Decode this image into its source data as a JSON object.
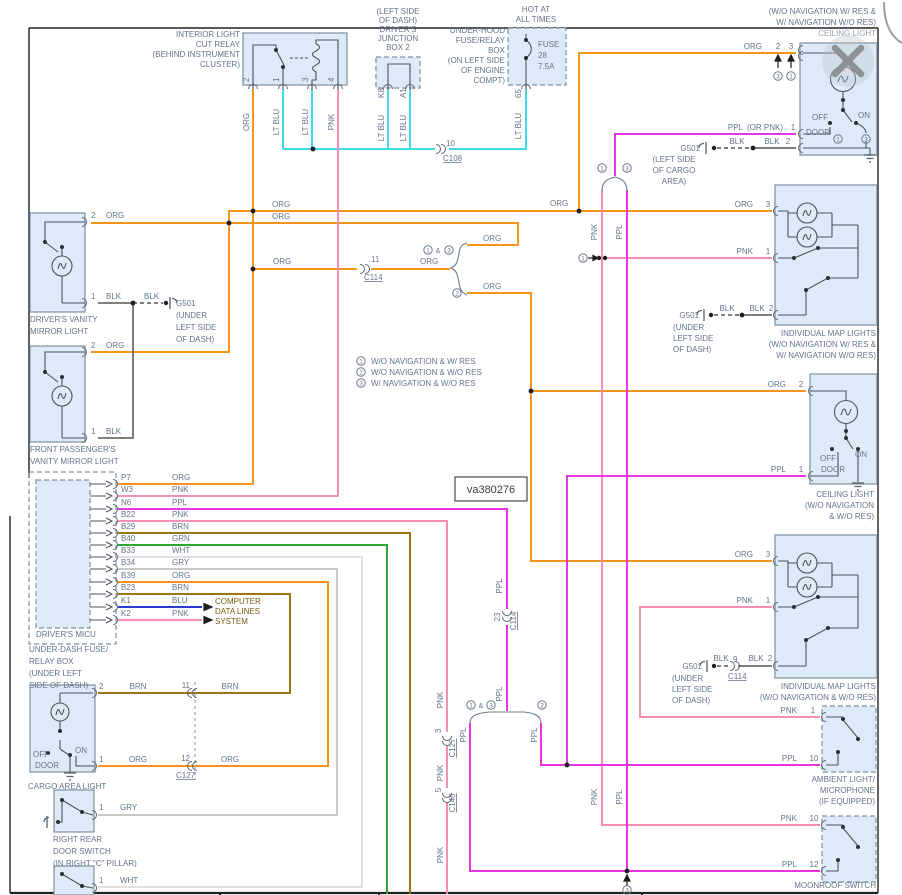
{
  "colors": {
    "org": "#F7941E",
    "ltblu": "#3FD9EE",
    "pnk": "#F78FB5",
    "ppl": "#E835E0",
    "brn": "#9B7613",
    "grn": "#2FA633",
    "wht": "#E0E0E0",
    "gry": "#C8C8C8",
    "blu": "#2B3BD6",
    "blk": "#6E6E6E",
    "box_fill": "#DCEBF7",
    "box_stroke": "#7E8F9F",
    "label": "#64748B",
    "note": "#7A5C10",
    "frame": "#222222"
  },
  "watermark": {
    "text": "va380276"
  },
  "legend": [
    {
      "num": "1",
      "label": "W/O NAVIGATION & W/ RES"
    },
    {
      "num": "2",
      "label": "W/O NAVIGATION & W/O RES"
    },
    {
      "num": "3",
      "label": "W/ NAVIGATION & W/O RES"
    }
  ],
  "labels": [
    {
      "n": "relay-title",
      "x": 240,
      "y": 37,
      "t": "INTERIOR LIGHT",
      "a": "e"
    },
    {
      "x": 240,
      "y": 47,
      "t": "CUT RELAY",
      "a": "e"
    },
    {
      "x": 240,
      "y": 57,
      "t": "(BEHIND INSTRUMENT",
      "a": "e"
    },
    {
      "x": 240,
      "y": 67,
      "t": "CLUSTER)",
      "a": "e"
    },
    {
      "x": 249,
      "y": 82,
      "t": "2",
      "r": 1
    },
    {
      "x": 279,
      "y": 82,
      "t": "1",
      "r": 1
    },
    {
      "x": 308,
      "y": 82,
      "t": "3",
      "r": 1
    },
    {
      "x": 334,
      "y": 82,
      "t": "4",
      "r": 1
    },
    {
      "x": 249,
      "y": 122,
      "t": "ORG",
      "r": 1,
      "a": "m"
    },
    {
      "x": 279,
      "y": 122,
      "t": "LT BLU",
      "r": 1,
      "a": "m"
    },
    {
      "x": 308,
      "y": 122,
      "t": "LT BLU",
      "r": 1,
      "a": "m"
    },
    {
      "x": 334,
      "y": 122,
      "t": "PNK",
      "r": 1,
      "a": "m"
    },
    {
      "n": "junction-box-label",
      "x": 398,
      "y": 14,
      "t": "(LEFT SIDE",
      "a": "m"
    },
    {
      "x": 398,
      "y": 23,
      "t": "OF DASH)",
      "a": "m"
    },
    {
      "x": 398,
      "y": 32,
      "t": "DRIVER'S",
      "a": "m"
    },
    {
      "x": 398,
      "y": 41,
      "t": "JUNCTION",
      "a": "m"
    },
    {
      "x": 398,
      "y": 50,
      "t": "BOX 2",
      "a": "m"
    },
    {
      "x": 384,
      "y": 98,
      "t": "K8",
      "r": 1
    },
    {
      "x": 406,
      "y": 98,
      "t": "A1",
      "r": 1
    },
    {
      "x": 384,
      "y": 128,
      "t": "LT BLU",
      "r": 1,
      "a": "m"
    },
    {
      "x": 406,
      "y": 128,
      "t": "LT BLU",
      "r": 1,
      "a": "m"
    },
    {
      "x": 446,
      "y": 146,
      "t": "10"
    },
    {
      "x": 443,
      "y": 161,
      "t": "C108",
      "u": 1
    },
    {
      "n": "hot-at-all-times",
      "x": 536,
      "y": 12,
      "t": "HOT AT",
      "a": "m"
    },
    {
      "x": 536,
      "y": 22,
      "t": "ALL TIMES",
      "a": "m"
    },
    {
      "n": "underhood-box-label",
      "x": 505,
      "y": 33,
      "t": "UNDER-HOOD",
      "a": "e"
    },
    {
      "x": 505,
      "y": 43,
      "t": "FUSE/RELAY",
      "a": "e"
    },
    {
      "x": 505,
      "y": 53,
      "t": "BOX",
      "a": "e"
    },
    {
      "x": 505,
      "y": 63,
      "t": "(ON LEFT SIDE",
      "a": "e"
    },
    {
      "x": 505,
      "y": 73,
      "t": "OF ENGINE",
      "a": "e"
    },
    {
      "x": 505,
      "y": 83,
      "t": "COMPT)",
      "a": "e"
    },
    {
      "n": "fuse-label",
      "x": 538,
      "y": 47,
      "t": "FUSE"
    },
    {
      "x": 538,
      "y": 58,
      "t": "28"
    },
    {
      "x": 538,
      "y": 69,
      "t": "7.5A"
    },
    {
      "x": 521,
      "y": 98,
      "t": "65",
      "r": 1
    },
    {
      "x": 521,
      "y": 126,
      "t": "LT BLU",
      "r": 1,
      "a": "m"
    },
    {
      "n": "ceiling1-variant",
      "x": 876,
      "y": 14,
      "t": "(W/O NAVIGATION W/ RES &",
      "a": "e"
    },
    {
      "x": 876,
      "y": 25,
      "t": "W/ NAVIGATION W/O RES)",
      "a": "e"
    },
    {
      "n": "ceiling1-title",
      "x": 876,
      "y": 36,
      "t": "CEILING LIGHT",
      "a": "e",
      "c": "#94A1AD"
    },
    {
      "x": 762,
      "y": 49,
      "t": "ORG",
      "a": "e"
    },
    {
      "x": 778,
      "y": 49,
      "t": "2",
      "a": "m"
    },
    {
      "x": 791,
      "y": 49,
      "t": "3",
      "a": "m"
    },
    {
      "x": 778,
      "y": 76,
      "t": "3",
      "circ": 1
    },
    {
      "x": 791,
      "y": 76,
      "t": "1",
      "circ": 1
    },
    {
      "x": 743,
      "y": 130,
      "t": "PPL",
      "a": "e"
    },
    {
      "x": 747,
      "y": 130,
      "t": "(OR PNK)"
    },
    {
      "x": 793,
      "y": 130,
      "t": "1",
      "a": "m"
    },
    {
      "x": 737,
      "y": 144,
      "t": "BLK",
      "a": "m"
    },
    {
      "x": 772,
      "y": 144,
      "t": "BLK",
      "a": "m"
    },
    {
      "x": 788,
      "y": 144,
      "t": "2",
      "a": "m"
    },
    {
      "x": 700,
      "y": 151,
      "t": "G501",
      "a": "e"
    },
    {
      "x": 674,
      "y": 162,
      "t": "(LEFT SIDE",
      "a": "m"
    },
    {
      "x": 674,
      "y": 173,
      "t": "OF CARGO",
      "a": "m"
    },
    {
      "x": 674,
      "y": 184,
      "t": "AREA)",
      "a": "m"
    },
    {
      "x": 820,
      "y": 120,
      "t": "OFF",
      "a": "m"
    },
    {
      "x": 864,
      "y": 118,
      "t": "ON",
      "a": "m"
    },
    {
      "x": 818,
      "y": 135,
      "t": "DOOR",
      "a": "m"
    },
    {
      "x": 838,
      "y": 139,
      "t": "1",
      "circ": 1
    },
    {
      "x": 866,
      "y": 139,
      "t": "3",
      "circ": 1
    },
    {
      "x": 272,
      "y": 207,
      "t": "ORG"
    },
    {
      "x": 272,
      "y": 219,
      "t": "ORG"
    },
    {
      "x": 550,
      "y": 206,
      "t": "ORG"
    },
    {
      "x": 753,
      "y": 207,
      "t": "ORG",
      "a": "e"
    },
    {
      "x": 768,
      "y": 207,
      "t": "3",
      "a": "m"
    },
    {
      "x": 273,
      "y": 264,
      "t": "ORG"
    },
    {
      "x": 420,
      "y": 264,
      "t": "ORG"
    },
    {
      "x": 371,
      "y": 262,
      "t": "11"
    },
    {
      "x": 364,
      "y": 280,
      "t": "C114",
      "u": 1
    },
    {
      "x": 428,
      "y": 250,
      "t": "1",
      "circ": 1
    },
    {
      "x": 438,
      "y": 253,
      "t": "&",
      "a": "m",
      "fs": 7
    },
    {
      "x": 449,
      "y": 250,
      "t": "3",
      "circ": 1
    },
    {
      "x": 483,
      "y": 241,
      "t": "ORG"
    },
    {
      "x": 457,
      "y": 293,
      "t": "2",
      "circ": 1
    },
    {
      "x": 483,
      "y": 289,
      "t": "ORG"
    },
    {
      "x": 602,
      "y": 168,
      "t": "1",
      "circ": 1
    },
    {
      "x": 627,
      "y": 168,
      "t": "3",
      "circ": 1
    },
    {
      "x": 597,
      "y": 232,
      "t": "PNK",
      "r": 1,
      "a": "m"
    },
    {
      "x": 622,
      "y": 232,
      "t": "PPL",
      "r": 1,
      "a": "m"
    },
    {
      "x": 583,
      "y": 258,
      "t": "1",
      "circ": 1
    },
    {
      "x": 753,
      "y": 254,
      "t": "PNK",
      "a": "e"
    },
    {
      "x": 768,
      "y": 254,
      "t": "1",
      "a": "m"
    },
    {
      "x": 699,
      "y": 318,
      "t": "G501",
      "a": "e"
    },
    {
      "x": 727,
      "y": 311,
      "t": "BLK",
      "a": "m"
    },
    {
      "x": 757,
      "y": 311,
      "t": "BLK",
      "a": "m"
    },
    {
      "x": 771,
      "y": 311,
      "t": "2",
      "a": "m"
    },
    {
      "x": 673,
      "y": 330,
      "t": "(UNDER"
    },
    {
      "x": 673,
      "y": 341,
      "t": "LEFT SIDE"
    },
    {
      "x": 673,
      "y": 352,
      "t": "OF DASH)"
    },
    {
      "n": "map1-title",
      "x": 876,
      "y": 336,
      "t": "INDIVIDUAL MAP LIGHTS",
      "a": "e"
    },
    {
      "x": 876,
      "y": 347,
      "t": "(W/O NAVIGATION W/ RES &",
      "a": "e"
    },
    {
      "x": 876,
      "y": 358,
      "t": "W/ NAVIGATION W/O RES)",
      "a": "e"
    },
    {
      "x": 361,
      "y": 361,
      "t": "1",
      "circ": 1
    },
    {
      "n": "legend-1",
      "x": 371,
      "y": 364,
      "t": "W/O NAVIGATION & W/ RES"
    },
    {
      "x": 361,
      "y": 372,
      "t": "2",
      "circ": 1
    },
    {
      "n": "legend-2",
      "x": 371,
      "y": 375,
      "t": "W/O NAVIGATION & W/O RES"
    },
    {
      "x": 361,
      "y": 383,
      "t": "3",
      "circ": 1
    },
    {
      "n": "legend-3",
      "x": 371,
      "y": 386,
      "t": "W/ NAVIGATION & W/O RES"
    },
    {
      "x": 91,
      "y": 218,
      "t": "2"
    },
    {
      "x": 106,
      "y": 218,
      "t": "ORG"
    },
    {
      "x": 91,
      "y": 299,
      "t": "1"
    },
    {
      "x": 106,
      "y": 299,
      "t": "BLK"
    },
    {
      "x": 144,
      "y": 299,
      "t": "BLK"
    },
    {
      "x": 176,
      "y": 306,
      "t": "G501"
    },
    {
      "x": 176,
      "y": 318,
      "t": "(UNDER"
    },
    {
      "x": 176,
      "y": 330,
      "t": "LEFT SIDE"
    },
    {
      "x": 176,
      "y": 342,
      "t": "OF DASH)"
    },
    {
      "n": "vanity1-title",
      "x": 30,
      "y": 322,
      "t": "DRIVER'S VANITY"
    },
    {
      "x": 30,
      "y": 334,
      "t": "MIRROR LIGHT"
    },
    {
      "x": 91,
      "y": 348,
      "t": "2"
    },
    {
      "x": 106,
      "y": 348,
      "t": "ORG"
    },
    {
      "x": 91,
      "y": 434,
      "t": "1"
    },
    {
      "x": 106,
      "y": 434,
      "t": "BLK"
    },
    {
      "n": "vanity2-title",
      "x": 30,
      "y": 452,
      "t": "FRONT PASSENGER'S"
    },
    {
      "x": 30,
      "y": 464,
      "t": "VANITY MIRROR LIGHT"
    },
    {
      "x": 121,
      "y": 480,
      "t": "P7"
    },
    {
      "x": 121,
      "y": 492,
      "t": "W3"
    },
    {
      "x": 121,
      "y": 505,
      "t": "N6"
    },
    {
      "x": 121,
      "y": 517,
      "t": "B22"
    },
    {
      "x": 121,
      "y": 529,
      "t": "B29"
    },
    {
      "x": 121,
      "y": 541,
      "t": "B40"
    },
    {
      "x": 121,
      "y": 553,
      "t": "B33"
    },
    {
      "x": 121,
      "y": 565,
      "t": "B34"
    },
    {
      "x": 121,
      "y": 578,
      "t": "B39"
    },
    {
      "x": 121,
      "y": 590,
      "t": "B23"
    },
    {
      "x": 121,
      "y": 603,
      "t": "K1"
    },
    {
      "x": 121,
      "y": 616,
      "t": "K2"
    },
    {
      "x": 172,
      "y": 480,
      "t": "ORG"
    },
    {
      "x": 172,
      "y": 492,
      "t": "PNK"
    },
    {
      "x": 172,
      "y": 505,
      "t": "PPL"
    },
    {
      "x": 172,
      "y": 517,
      "t": "PNK"
    },
    {
      "x": 172,
      "y": 529,
      "t": "BRN"
    },
    {
      "x": 172,
      "y": 541,
      "t": "GRN"
    },
    {
      "x": 172,
      "y": 553,
      "t": "WHT"
    },
    {
      "x": 172,
      "y": 565,
      "t": "GRY"
    },
    {
      "x": 172,
      "y": 578,
      "t": "ORG"
    },
    {
      "x": 172,
      "y": 590,
      "t": "BRN"
    },
    {
      "x": 172,
      "y": 603,
      "t": "BLU"
    },
    {
      "x": 172,
      "y": 616,
      "t": "PNK"
    },
    {
      "n": "micu-title",
      "x": 36,
      "y": 637,
      "t": "DRIVER'S MICU"
    },
    {
      "n": "underdash-label",
      "x": 29,
      "y": 652,
      "t": "UNDER-DASH FUSE/"
    },
    {
      "x": 29,
      "y": 664,
      "t": "RELAY BOX"
    },
    {
      "x": 29,
      "y": 676,
      "t": "(UNDER LEFT"
    },
    {
      "x": 29,
      "y": 688,
      "t": "SIDE OF DASH)"
    },
    {
      "n": "computer-note",
      "x": 215,
      "y": 604,
      "t": "COMPUTER",
      "c": "#7A5C10"
    },
    {
      "x": 215,
      "y": 614,
      "t": "DATA LINES",
      "c": "#7A5C10"
    },
    {
      "x": 215,
      "y": 624,
      "t": "SYSTEM",
      "c": "#7A5C10"
    },
    {
      "n": "diagram-id",
      "x": 491,
      "y": 493,
      "t": "va380276",
      "a": "m",
      "fs": 11,
      "c": "#3D3D3D"
    },
    {
      "x": 786,
      "y": 387,
      "t": "ORG",
      "a": "e"
    },
    {
      "x": 801,
      "y": 387,
      "t": "2",
      "a": "m"
    },
    {
      "x": 786,
      "y": 472,
      "t": "PPL",
      "a": "e"
    },
    {
      "x": 801,
      "y": 472,
      "t": "1",
      "a": "m"
    },
    {
      "x": 828,
      "y": 461,
      "t": "OFF",
      "a": "m"
    },
    {
      "x": 861,
      "y": 457,
      "t": "ON",
      "a": "m"
    },
    {
      "x": 833,
      "y": 472,
      "t": "DOOR",
      "a": "m"
    },
    {
      "n": "ceiling2-title",
      "x": 874,
      "y": 497,
      "t": "CEILING LIGHT",
      "a": "e"
    },
    {
      "x": 874,
      "y": 508,
      "t": "(W/O NAVIGATION",
      "a": "e"
    },
    {
      "x": 874,
      "y": 519,
      "t": "& W/O RES)",
      "a": "e"
    },
    {
      "x": 753,
      "y": 557,
      "t": "ORG",
      "a": "e"
    },
    {
      "x": 768,
      "y": 557,
      "t": "3",
      "a": "m"
    },
    {
      "x": 753,
      "y": 603,
      "t": "PNK",
      "a": "e"
    },
    {
      "x": 768,
      "y": 603,
      "t": "1",
      "a": "m"
    },
    {
      "x": 702,
      "y": 669,
      "t": "G501",
      "a": "e"
    },
    {
      "x": 721,
      "y": 661,
      "t": "BLK",
      "a": "m"
    },
    {
      "x": 733,
      "y": 662,
      "t": "9"
    },
    {
      "x": 756,
      "y": 661,
      "t": "BLK",
      "a": "m"
    },
    {
      "x": 770,
      "y": 661,
      "t": "2",
      "a": "m"
    },
    {
      "x": 728,
      "y": 679,
      "t": "C114",
      "u": 1
    },
    {
      "x": 672,
      "y": 681,
      "t": "(UNDER"
    },
    {
      "x": 672,
      "y": 692,
      "t": "LEFT SIDE"
    },
    {
      "x": 672,
      "y": 703,
      "t": "OF DASH)"
    },
    {
      "n": "map2-title",
      "x": 876,
      "y": 689,
      "t": "INDIVIDUAL MAP LIGHTS",
      "a": "e"
    },
    {
      "x": 876,
      "y": 700,
      "t": "(W/O NAVIGATION & W/O RES)",
      "a": "e"
    },
    {
      "x": 797,
      "y": 713,
      "t": "PNK",
      "a": "e"
    },
    {
      "x": 813,
      "y": 713,
      "t": "1",
      "a": "m"
    },
    {
      "x": 797,
      "y": 761,
      "t": "PPL",
      "a": "e"
    },
    {
      "x": 814,
      "y": 761,
      "t": "10",
      "a": "m"
    },
    {
      "n": "ambient-title",
      "x": 875,
      "y": 782,
      "t": "AMBIENT LIGHT/",
      "a": "e"
    },
    {
      "x": 875,
      "y": 793,
      "t": "MICROPHONE",
      "a": "e"
    },
    {
      "x": 875,
      "y": 804,
      "t": "(IF EQUIPPED)",
      "a": "e"
    },
    {
      "x": 797,
      "y": 821,
      "t": "PNK",
      "a": "e"
    },
    {
      "x": 814,
      "y": 821,
      "t": "10",
      "a": "m"
    },
    {
      "x": 797,
      "y": 867,
      "t": "PPL",
      "a": "e"
    },
    {
      "x": 814,
      "y": 867,
      "t": "12",
      "a": "m"
    },
    {
      "n": "moonroof-title",
      "x": 876,
      "y": 888,
      "t": "MOONROOF SWITCH",
      "a": "e"
    },
    {
      "x": 99,
      "y": 689,
      "t": "2"
    },
    {
      "x": 138,
      "y": 689,
      "t": "BRN",
      "a": "m"
    },
    {
      "x": 190,
      "y": 688,
      "t": "11",
      "a": "e"
    },
    {
      "x": 230,
      "y": 689,
      "t": "BRN",
      "a": "m"
    },
    {
      "x": 99,
      "y": 762,
      "t": "1"
    },
    {
      "x": 138,
      "y": 762,
      "t": "ORG",
      "a": "m"
    },
    {
      "x": 190,
      "y": 761,
      "t": "12",
      "a": "e"
    },
    {
      "x": 176,
      "y": 778,
      "t": "C127",
      "u": 1
    },
    {
      "x": 230,
      "y": 762,
      "t": "ORG",
      "a": "m"
    },
    {
      "x": 33,
      "y": 757,
      "t": "OFF"
    },
    {
      "x": 75,
      "y": 753,
      "t": "ON"
    },
    {
      "x": 35,
      "y": 768,
      "t": "DOOR"
    },
    {
      "n": "cargo-title",
      "x": 28,
      "y": 789,
      "t": "CARGO AREA LIGHT"
    },
    {
      "x": 99,
      "y": 810,
      "t": "1"
    },
    {
      "x": 120,
      "y": 810,
      "t": "GRY"
    },
    {
      "n": "rr-switch-title",
      "x": 53,
      "y": 842,
      "t": "RIGHT REAR"
    },
    {
      "x": 53,
      "y": 854,
      "t": "DOOR SWITCH"
    },
    {
      "x": 53,
      "y": 866,
      "t": "(IN RIGHT \"C\" PILLAR)"
    },
    {
      "x": 99,
      "y": 883,
      "t": "1"
    },
    {
      "x": 120,
      "y": 883,
      "t": "WHT"
    },
    {
      "x": 443,
      "y": 700,
      "t": "PNK",
      "r": 1,
      "a": "m"
    },
    {
      "x": 441,
      "y": 731,
      "t": "3",
      "r": 1,
      "a": "m"
    },
    {
      "x": 455,
      "y": 748,
      "t": "C127",
      "r": 1,
      "a": "m",
      "u": 1
    },
    {
      "x": 443,
      "y": 773,
      "t": "PNK",
      "r": 1,
      "a": "m"
    },
    {
      "x": 441,
      "y": 790,
      "t": "5",
      "r": 1,
      "a": "m"
    },
    {
      "x": 455,
      "y": 803,
      "t": "C146",
      "r": 1,
      "a": "m",
      "u": 1
    },
    {
      "x": 443,
      "y": 855,
      "t": "PNK",
      "r": 1,
      "a": "m"
    },
    {
      "x": 466,
      "y": 735,
      "t": "PPL",
      "r": 1,
      "a": "m"
    },
    {
      "x": 537,
      "y": 735,
      "t": "PPL",
      "r": 1,
      "a": "m"
    },
    {
      "x": 502,
      "y": 586,
      "t": "PPL",
      "r": 1,
      "a": "m"
    },
    {
      "x": 502,
      "y": 694,
      "t": "PPL",
      "r": 1,
      "a": "m"
    },
    {
      "x": 500,
      "y": 617,
      "t": "23",
      "r": 1,
      "a": "m"
    },
    {
      "x": 516,
      "y": 621,
      "t": "C114",
      "r": 1,
      "a": "m",
      "u": 1
    },
    {
      "x": 597,
      "y": 797,
      "t": "PNK",
      "r": 1,
      "a": "m"
    },
    {
      "x": 622,
      "y": 797,
      "t": "PPL",
      "r": 1,
      "a": "m"
    },
    {
      "x": 471,
      "y": 705,
      "t": "1",
      "circ": 1
    },
    {
      "x": 481,
      "y": 708,
      "t": "&",
      "a": "m",
      "fs": 7
    },
    {
      "x": 491,
      "y": 705,
      "t": "3",
      "circ": 1
    },
    {
      "x": 542,
      "y": 705,
      "t": "2",
      "circ": 1
    },
    {
      "x": 627,
      "y": 890,
      "t": "3",
      "circ": 1
    }
  ]
}
